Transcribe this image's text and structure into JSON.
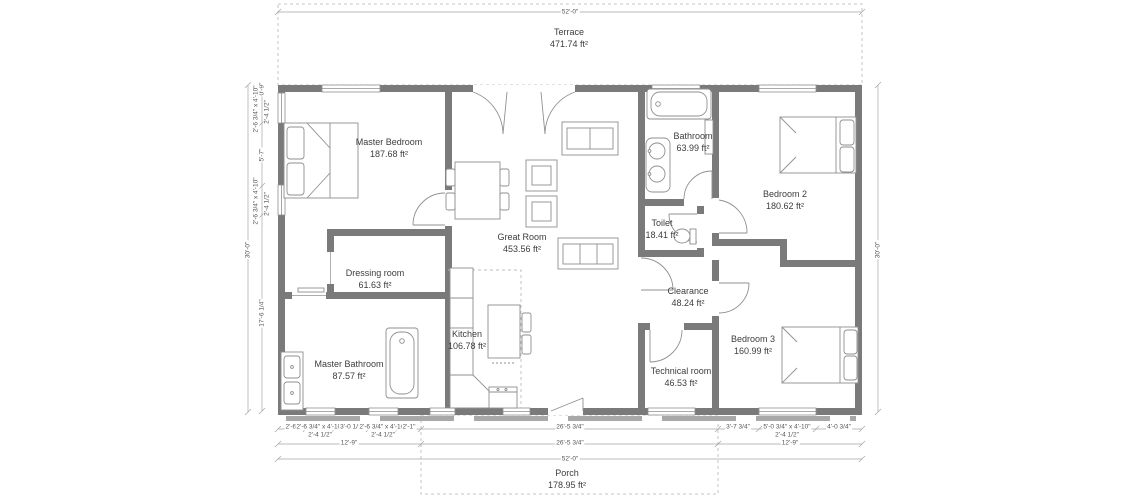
{
  "floor_plan": {
    "rooms": {
      "terrace": {
        "name": "Terrace",
        "area": "471.74 ft²"
      },
      "master_bedroom": {
        "name": "Master Bedroom",
        "area": "187.68 ft²"
      },
      "great_room": {
        "name": "Great Room",
        "area": "453.56 ft²"
      },
      "bathroom": {
        "name": "Bathroom",
        "area": "63.99 ft²"
      },
      "toilet": {
        "name": "Toilet",
        "area": "18.41 ft²"
      },
      "bedroom2": {
        "name": "Bedroom 2",
        "area": "180.62 ft²"
      },
      "dressing": {
        "name": "Dressing room",
        "area": "61.63 ft²"
      },
      "clearance": {
        "name": "Clearance",
        "area": "48.24 ft²"
      },
      "kitchen": {
        "name": "Kitchen",
        "area": "106.78 ft²"
      },
      "master_bathroom": {
        "name": "Master Bathroom",
        "area": "87.57 ft²"
      },
      "technical": {
        "name": "Technical room",
        "area": "46.53 ft²"
      },
      "bedroom3": {
        "name": "Bedroom 3",
        "area": "160.99 ft²"
      },
      "porch": {
        "name": "Porch",
        "area": "178.95 ft²"
      }
    },
    "dimensions": {
      "overall_width": "52'-0\"",
      "overall_height": "30'-0\"",
      "left_chain": {
        "seg_top": "0'-9\"",
        "window_small": "2'-6 3/4\" x 4'-10\"",
        "sill": "2'-4 1/2\"",
        "seg_mid": "5'-7\"",
        "seg_bottom": "17'-6 1/4\""
      },
      "bottom_row1": {
        "seg1": "2'-6\"",
        "window_small": "2'-6 3/4\" x 4'-10\"",
        "sill": "2'-4 1/2\"",
        "seg2": "3'-0 1/2\"",
        "seg3": "2'-1\"",
        "center": "26'-5 3/4\"",
        "seg4": "3'-7 3/4\"",
        "window_big": "5'-0 3/4\" x 4'-10\"",
        "seg5": "4'-0 3/4\""
      },
      "bottom_row2": {
        "left": "12'-9\"",
        "center": "26'-5 3/4\"",
        "right": "12'-9\""
      }
    }
  }
}
